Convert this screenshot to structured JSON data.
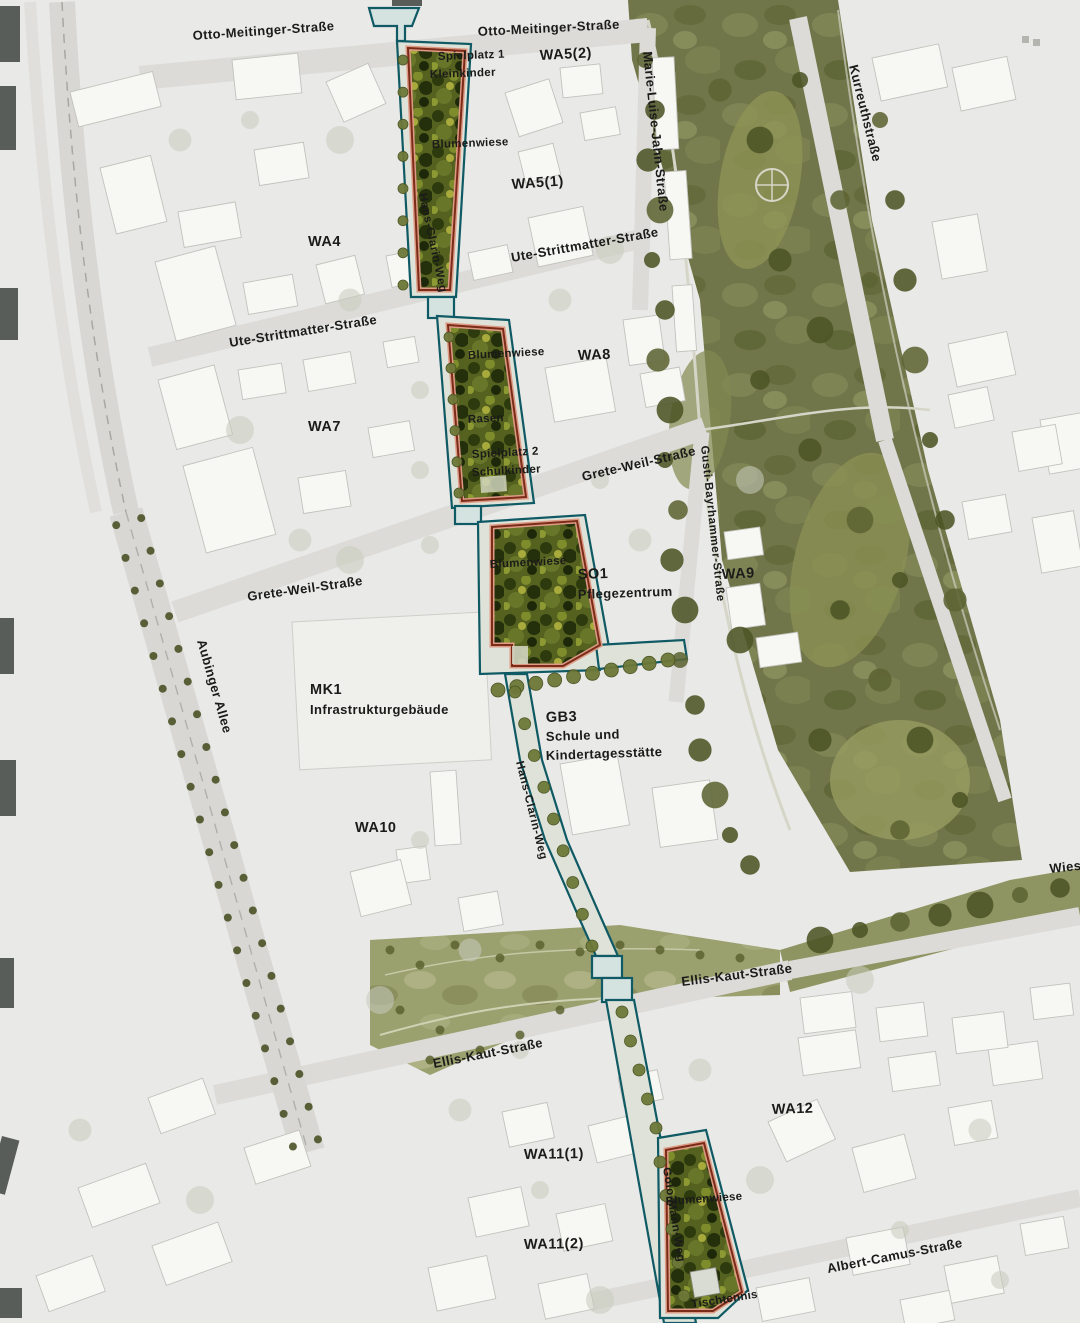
{
  "map_title": "Site plan – Hans-Clarin-Weg green corridor",
  "streets": {
    "otto_meitinger": "Otto-Meitinger-Straße",
    "marie_luise_jahn": "Marie-Luise-Jahn-Straße",
    "kurreuth": "Kurreuthstraße",
    "ute_strittmatter": "Ute-Strittmatter-Straße",
    "grete_weil": "Grete-Weil-Straße",
    "gusti_bayrhammer": "Gusti-Bayrhammer-Straße",
    "aubinger_allee": "Aubinger Allee",
    "hans_clarin_weg": "Hans-Clarin-Weg",
    "ellis_kaut": "Ellis-Kaut-Straße",
    "golo_mann_weg": "Golo-Mann-Weg",
    "albert_camus": "Albert-Camus-Straße",
    "wies_truncated": "Wies"
  },
  "areas": {
    "wa4": "WA4",
    "wa5_1": "WA5(1)",
    "wa5_2": "WA5(2)",
    "wa7": "WA7",
    "wa8": "WA8",
    "wa9": "WA9",
    "wa10": "WA10",
    "wa11_1": "WA11(1)",
    "wa11_2": "WA11(2)",
    "wa12": "WA12",
    "so1_code": "SO1",
    "so1_use": "Pflegezentrum",
    "mk1_code": "MK1",
    "mk1_use": "Infrastrukturgebäude",
    "gb3_code": "GB3",
    "gb3_use_line1": "Schule und",
    "gb3_use_line2": "Kindertagesstätte"
  },
  "green_features": {
    "playground1_line1": "Spielplatz 1",
    "playground1_line2": "Kleinkinder",
    "meadow": "Blumenwiese",
    "lawn": "Rasen",
    "playground2_line1": "Spielplatz 2",
    "playground2_line2": "Schulkinder",
    "table_tennis": "Tischtennis"
  },
  "colors": {
    "background": "#e9e9e7",
    "park_green": "#71764a",
    "planting_green": "#55611f",
    "path_teal": "#0f5a64",
    "patch_outline": "#7a2c18",
    "street_gray": "#dcdbd8",
    "building_fill": "#f7f7f4",
    "label_black": "#1b1b19"
  }
}
